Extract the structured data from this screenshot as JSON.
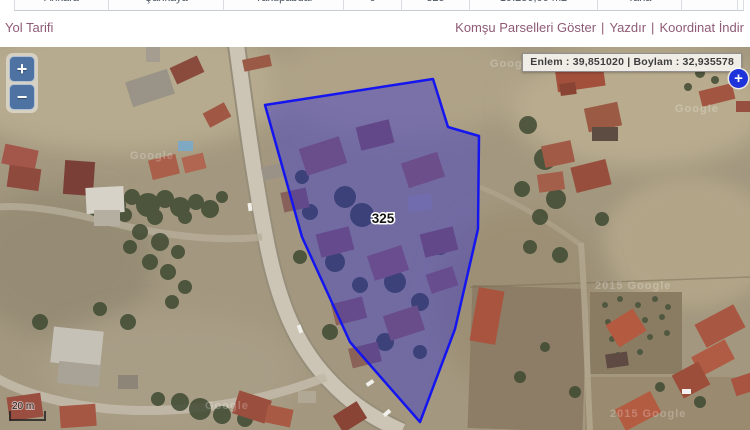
{
  "parcel_table": {
    "row": [
      "Ankara",
      "Çankaya",
      "Yakupabdal",
      "0",
      "325",
      "19.250,00 m2",
      "Tarla",
      "",
      ""
    ]
  },
  "actions": {
    "yol_tarifi": "Yol Tarifi",
    "komsu_parselleri": "Komşu Parselleri Göster",
    "yazdir": "Yazdır",
    "koordinat_indir": "Koordinat İndir",
    "separator": "|"
  },
  "map": {
    "coordinates_label": "Enlem : 39,851020 | Boylam : 32,935578",
    "parcel": {
      "label": "325",
      "points": "265,58 433,32 448,80 479,89 478,182 455,282 420,375 350,295 302,190"
    },
    "controls": {
      "zoom_in": "+",
      "zoom_out": "−",
      "expand": "+"
    },
    "scale_label": "20 m",
    "watermark": "Google",
    "watermark_dated": "2015 Google"
  },
  "colors": {
    "link": "#8e5a76",
    "parcel_fill": "#2222dd",
    "parcel_stroke": "#1515ef",
    "zoom_button_blue": "#4e73a2",
    "expand_button_blue": "#1e33d9"
  }
}
